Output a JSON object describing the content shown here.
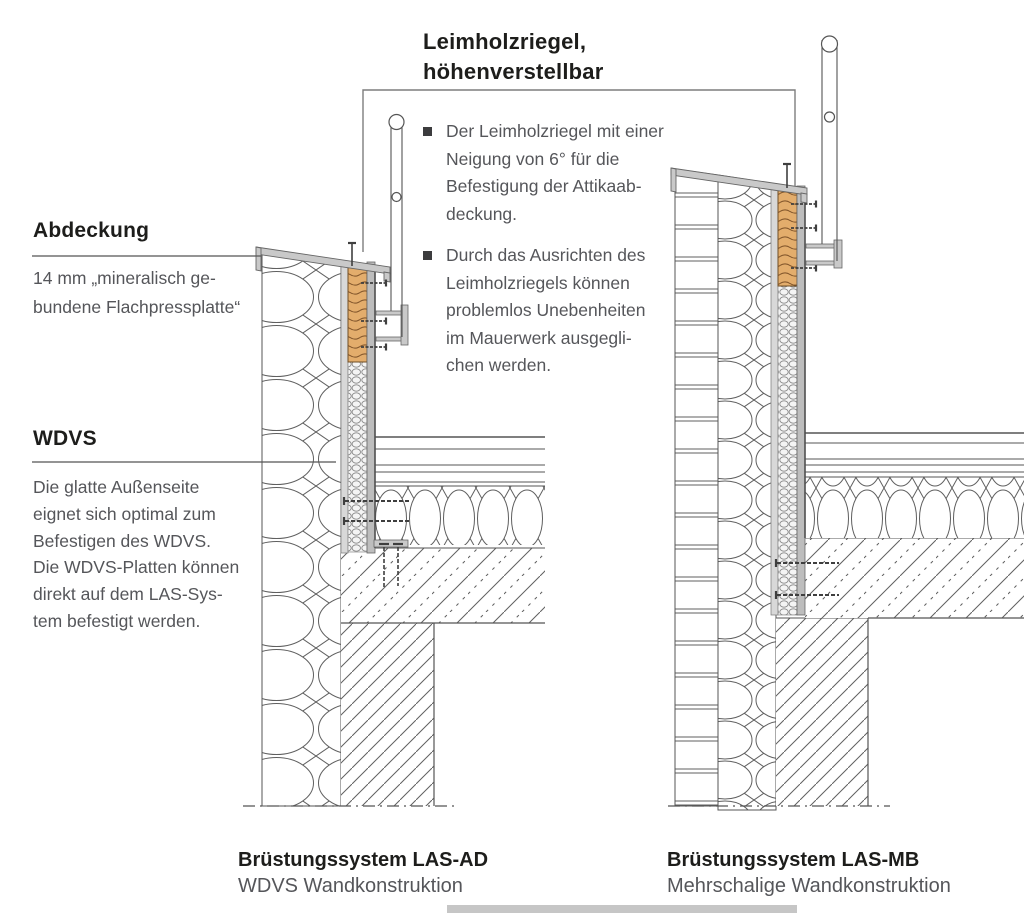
{
  "callout": {
    "title": "Leimholzriegel,\nhöhenverstellbar",
    "bullets": [
      "Der Leimholzriegel mit einer\nNeigung von 6° für die\nBefestigung der Attikaab-\ndeckung.",
      "Durch das Ausrichten des\nLeimholzriegels können\nproblemlos Unebenheiten\nim Mauerwerk ausgegli-\nchen werden."
    ]
  },
  "side_labels": {
    "abdeckung_heading": "Abdeckung",
    "abdeckung_body": "14 mm „mineralisch ge-\nbundene Flachpressplatte“",
    "wdvs_heading": "WDVS",
    "wdvs_body": "Die glatte Außenseite\neignet sich optimal zum\nBefestigen des WDVS.\nDie WDVS-Platten können\ndirekt auf dem LAS-Sys-\ntem befestigt werden."
  },
  "captions": {
    "left": {
      "title": "Brüstungssystem LAS-AD",
      "subtitle": "WDVS Wandkonstruktion"
    },
    "right": {
      "title": "Brüstungssystem LAS-MB",
      "subtitle": "Mehrschalige Wandkonstruktion"
    }
  },
  "colors": {
    "wood": "#e3ad6c",
    "metal": "#c7c7c7",
    "outline": "#4f4f4f",
    "heading_text": "#1d1d1b",
    "body_text": "#55565a",
    "bottom_bar": "#c6c6c6"
  }
}
